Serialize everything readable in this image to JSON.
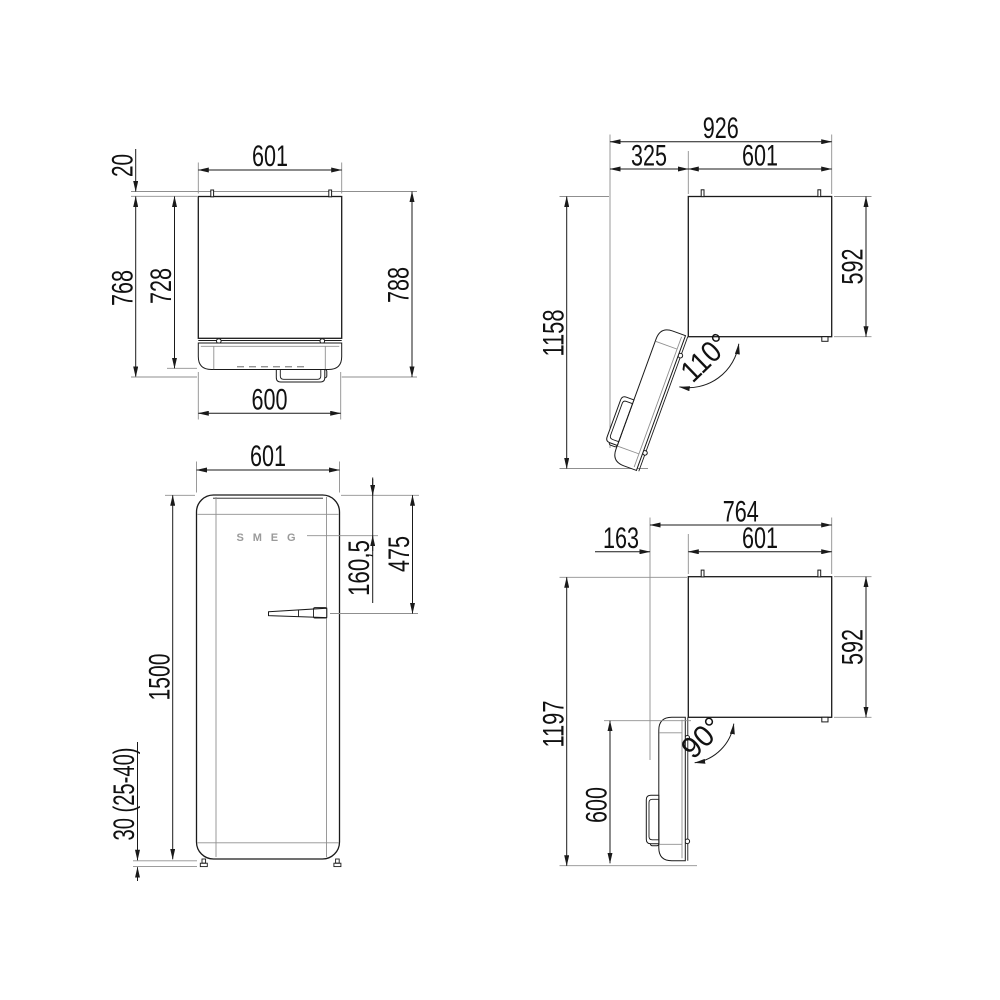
{
  "drawing": {
    "brand": "SMEG",
    "colors": {
      "line": "#1a1a1a",
      "extension": "#8f8f8f",
      "background": "#ffffff"
    },
    "views": {
      "top_closed": {
        "width_top": "601",
        "rear_gap": "20",
        "depth_body": "728",
        "depth_door": "768",
        "depth_total": "788",
        "width_door": "600"
      },
      "door_110": {
        "width_total": "926",
        "door_projection": "325",
        "width_body": "601",
        "depth_total": "1158",
        "depth_body": "592",
        "angle": "110°"
      },
      "front": {
        "width": "601",
        "height": "1500",
        "logo_offset": "160,5",
        "handle_offset": "475",
        "feet": "30 (25-40)"
      },
      "door_90": {
        "width_total": "764",
        "door_projection": "163",
        "width_body": "601",
        "depth_total": "1197",
        "depth_body": "592",
        "door_length": "600",
        "angle": "90°"
      }
    }
  }
}
